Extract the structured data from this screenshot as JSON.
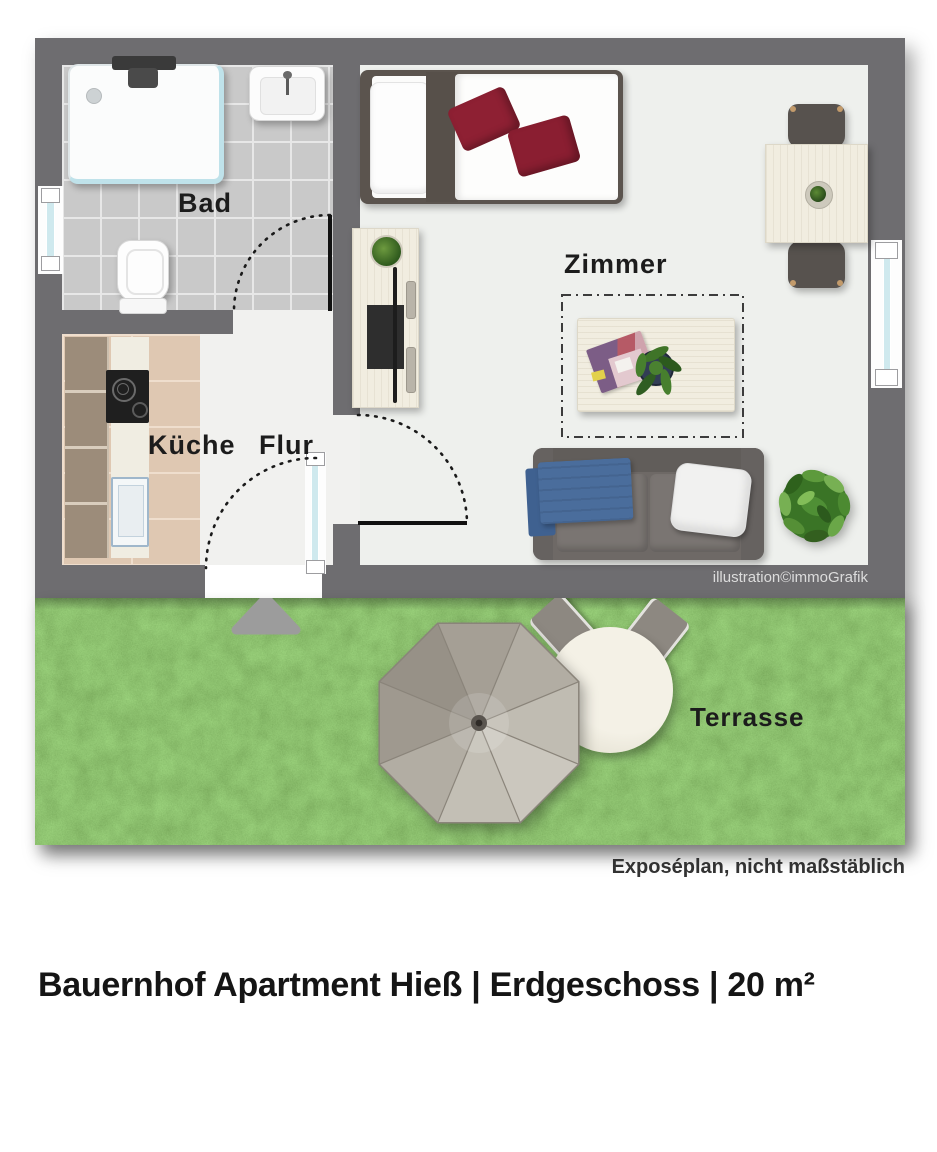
{
  "plan": {
    "rooms": [
      {
        "id": "bad",
        "label": "Bad"
      },
      {
        "id": "kueche",
        "label": "Küche"
      },
      {
        "id": "flur",
        "label": "Flur"
      },
      {
        "id": "zimmer",
        "label": "Zimmer"
      },
      {
        "id": "terrasse",
        "label": "Terrasse"
      }
    ],
    "credit": "illustration©immoGrafik",
    "disclaimer": "Exposéplan, nicht maßstäblich"
  },
  "title": "Bauernhof Apartment Hieß | Erdgeschoss | 20 m²",
  "colors": {
    "wall": "#6e6d70",
    "room_floor": "#eef0ed",
    "bad_tile": "#c9c9c9",
    "kueche_tile": "#dfc8b2",
    "grass": "#5f983c",
    "bed_accent_pillow": "#8e2033",
    "sofa_throw_blue": "#4a6d9c",
    "window_glass": "#cfe9ee",
    "umbrella": "#b2ada3"
  }
}
